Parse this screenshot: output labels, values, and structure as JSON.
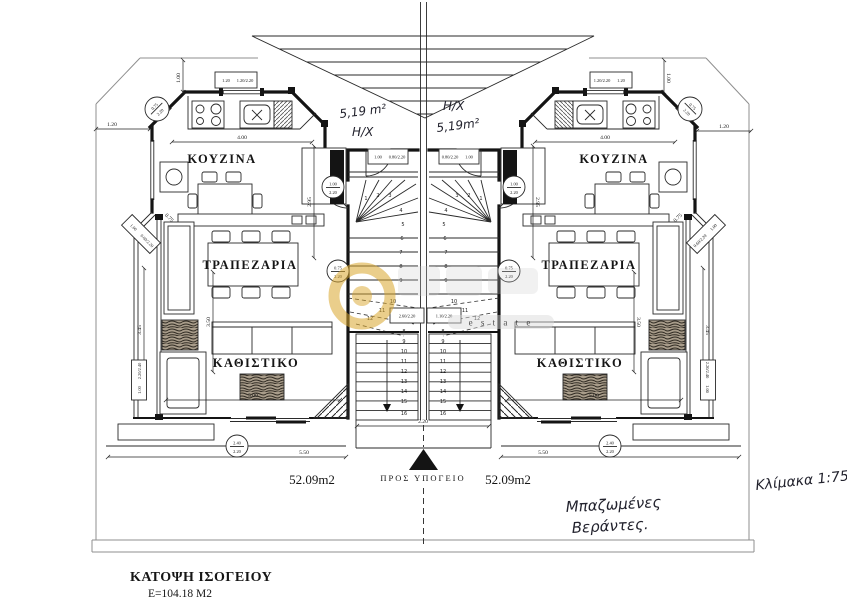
{
  "colors": {
    "ink": "#141414",
    "boundary": "#8f8f8f",
    "watermark_gold": "#d9a62b",
    "paper": "#ffffff"
  },
  "rooms": {
    "kitchen": "ΚΟΥΖΙΝΑ",
    "dining": "ΤΡΑΠΕΖΑΡΙΑ",
    "living": "ΚΑΘΙΣΤΙΚΟ"
  },
  "units": {
    "left_area": "52.09m2",
    "right_area": "52.09m2"
  },
  "entry": {
    "left_hall": "Η/Χ",
    "left_hall_area": "5,19 m²",
    "right_hall": "Η/Χ",
    "right_hall_area": "5,19m²"
  },
  "stairs": {
    "to_basement": "ΠΡΟΣ ΥΠΟΓΕΙΟ",
    "upper": [
      "1",
      "2",
      "3",
      "4",
      "5",
      "6",
      "7",
      "8",
      "9"
    ],
    "winders": [
      "10",
      "11",
      "12"
    ],
    "lower": [
      "8",
      "9",
      "10",
      "11",
      "12",
      "13",
      "14",
      "15",
      "16"
    ]
  },
  "dims": {
    "d075": "0.75",
    "d100": "1.00",
    "d120": "1.20",
    "d220": "2.20",
    "d240": "2.40",
    "d295": "2.95",
    "d345": "3.45",
    "d350": "3.50",
    "d400": "4.00",
    "d500": "5.00",
    "d550": "5.50",
    "f075_220": "0.75/2.20",
    "f060_220": "0.60/2.20",
    "f080_220": "0.80/2.20",
    "f100_220": "1.00/2.20",
    "f120_220": "1.20/2.20",
    "f220_240": "2.20/2.40",
    "f260_220": "2.60/2.20",
    "f110_220": "1.10/2.20"
  },
  "watermark": {
    "estate": "e s t a t e"
  },
  "notes": {
    "verandas1": "Μπαζωμένες",
    "verandas2": "Βεράντες.",
    "scale": "Κλίμακα 1:75"
  },
  "title": {
    "name": "ΚΑΤΟΨΗ ΙΣΟΓΕΙΟΥ",
    "area": "Ε=104.18 Μ2"
  }
}
